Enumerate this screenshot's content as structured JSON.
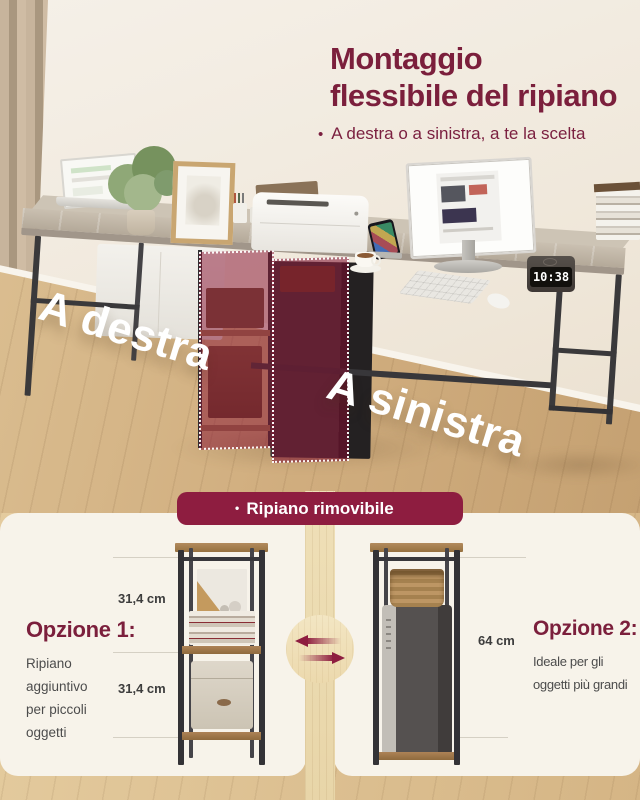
{
  "colors": {
    "maroon_accent": "#8E1D40",
    "title_maroon": "#7B1F3C",
    "cream_panel": "#F7F3EA",
    "wood_floor": "#D9BC8E",
    "text_gray": "#4C4C4C",
    "overlay_red": "rgba(136,22,52,0.52)"
  },
  "header": {
    "title_line1": "Montaggio",
    "title_line2": "flessibile del ripiano",
    "bullet": "•",
    "subtitle": "A destra o a sinistra, a te la scelta"
  },
  "photo": {
    "label_right_mount": "A destra",
    "label_left_mount": "A sinistra",
    "clock_time": "10:38"
  },
  "banner": {
    "bullet": "•",
    "label": "Ripiano rimovibile"
  },
  "options": {
    "option1": {
      "title": "Opzione 1:",
      "desc_lines": [
        "Ripiano",
        "aggiuntivo",
        "per piccoli",
        "oggetti"
      ],
      "measure_top": "31,4 cm",
      "measure_bottom": "31,4 cm"
    },
    "option2": {
      "title": "Opzione 2:",
      "desc_lines": [
        "Ideale per gli",
        "oggetti più grandi"
      ],
      "measure": "64 cm"
    }
  },
  "icons": {
    "swap_arrows": "two opposing horizontal arrows (left/right swap)"
  }
}
